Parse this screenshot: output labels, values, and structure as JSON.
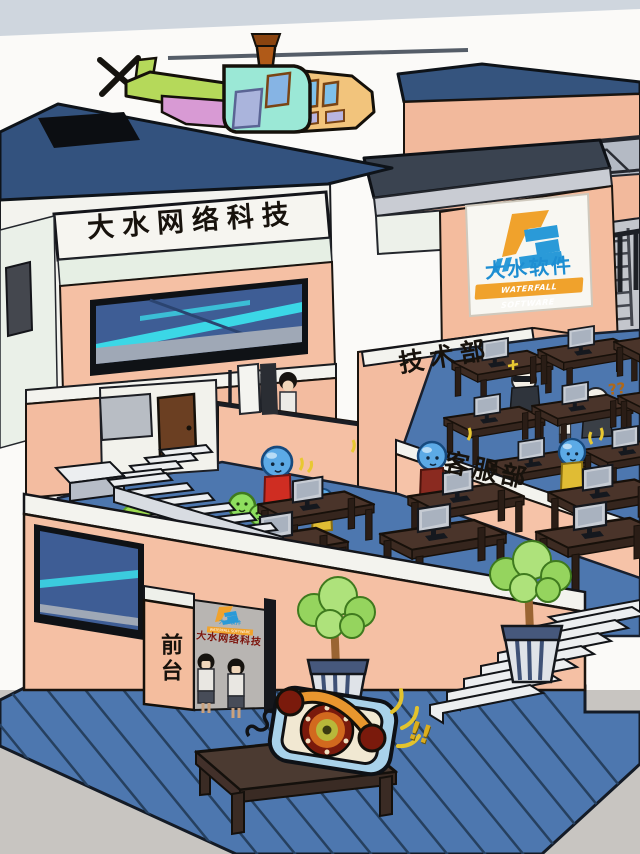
{
  "scene": {
    "title_sign": "大水网络科技",
    "logo": {
      "name": "大水软件",
      "tagline": "WATERFALL SOFTWARE"
    },
    "labels": {
      "tech_dept": "技术部",
      "service_dept": "客服部",
      "front_desk": "前台"
    },
    "entrance_sign": {
      "logo_name": "大水软件",
      "tagline": "WATERFALL SOFTWARE",
      "company": "大水网络科技"
    },
    "effects": {
      "confusion": "??",
      "phone_ring": "!!"
    },
    "colors": {
      "brand_orange": "#f0a22c",
      "brand_blue": "#2a9ad8",
      "sign_red": "#7c140c",
      "ring_yellow": "#dcae1e",
      "wall_salmon": "#f5c0a4",
      "floor_blue": "#4d77af"
    }
  }
}
